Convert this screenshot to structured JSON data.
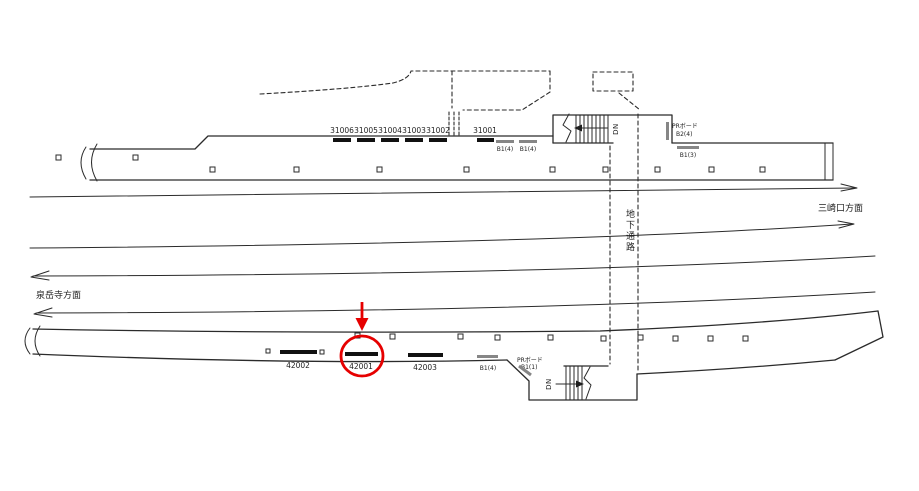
{
  "direction_right": "三崎口方面",
  "direction_left": "泉岳寺方面",
  "passage_label": "地下通路",
  "stair_label_top": "DN",
  "stair_label_bottom": "DN",
  "top_boards": [
    "31006",
    "31005",
    "31004",
    "31003",
    "31002",
    "31001"
  ],
  "top_small_boards": [
    "B1(4)",
    "B1(4)"
  ],
  "top_pr_board": {
    "line1": "PRボード",
    "line2": "B2(4)"
  },
  "top_b13_board": "B1(3)",
  "bottom_boards": [
    "42002",
    "42001",
    "42003"
  ],
  "bottom_small_board": "B1(4)",
  "bottom_pr_board": {
    "line1": "PRボード",
    "line2": "B1(1)"
  },
  "highlight": {
    "target": "42001",
    "color": "#e60000"
  }
}
